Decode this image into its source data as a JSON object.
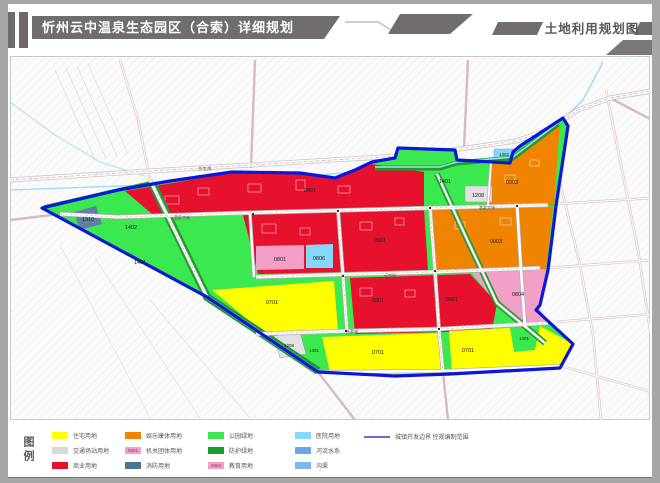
{
  "header": {
    "title": "忻州云中温泉生态园区（合索）详细规划",
    "map_label": "土地利用规划图"
  },
  "legend": {
    "title": "图例",
    "items": [
      {
        "label": "住宅用地",
        "color": "#ffff00"
      },
      {
        "label": "交通场站用地",
        "color": "#d9d9d9"
      },
      {
        "label": "商业用地",
        "color": "#e8112d"
      },
      {
        "label": "娱乐康体用地",
        "color": "#f08300"
      },
      {
        "label": "机关团体用地",
        "color": "#f2a0c8",
        "chip_label": "0801"
      },
      {
        "label": "消防用地",
        "color": "#4f7396"
      },
      {
        "label": "公园绿地",
        "color": "#3ce84f"
      },
      {
        "label": "防护绿地",
        "color": "#1a9e2c"
      },
      {
        "label": "教育用地",
        "color": "#f2a0c8",
        "chip_label": "0804"
      },
      {
        "label": "医院用地",
        "color": "#86d8f8"
      },
      {
        "label": "河流水系",
        "color": "#68a7e6"
      },
      {
        "label": "沟渠",
        "color": "#79b7ec"
      }
    ],
    "boundary": {
      "label": "城镇开发边界 控规编制范围",
      "color": "#6b6bd6"
    }
  },
  "colors": {
    "residential": "#ffff00",
    "commercial": "#e8112d",
    "entertainment": "#f08300",
    "government_pink": "#f2a0c8",
    "medical_blue": "#86d8f8",
    "park_green": "#3ce84f",
    "protective_green": "#1a9e2c",
    "transport_gray": "#e2e2e2",
    "parcel_1310": "#5f7fa5",
    "boundary_blue": "#0a17d8",
    "water": "#a6dcef"
  },
  "map": {
    "parcel_labels": [
      "1310",
      "1401",
      "1402",
      "0901",
      "0901",
      "0801",
      "0806",
      "1401",
      "1208",
      "0903",
      "1302",
      "0903",
      "0901",
      "0901",
      "0804",
      "0701",
      "1208",
      "1401",
      "0701",
      "0701",
      "1401"
    ],
    "road_labels": [
      "忻五线",
      "温泉大街",
      "温泉大街",
      "云中街",
      "合索街"
    ]
  }
}
